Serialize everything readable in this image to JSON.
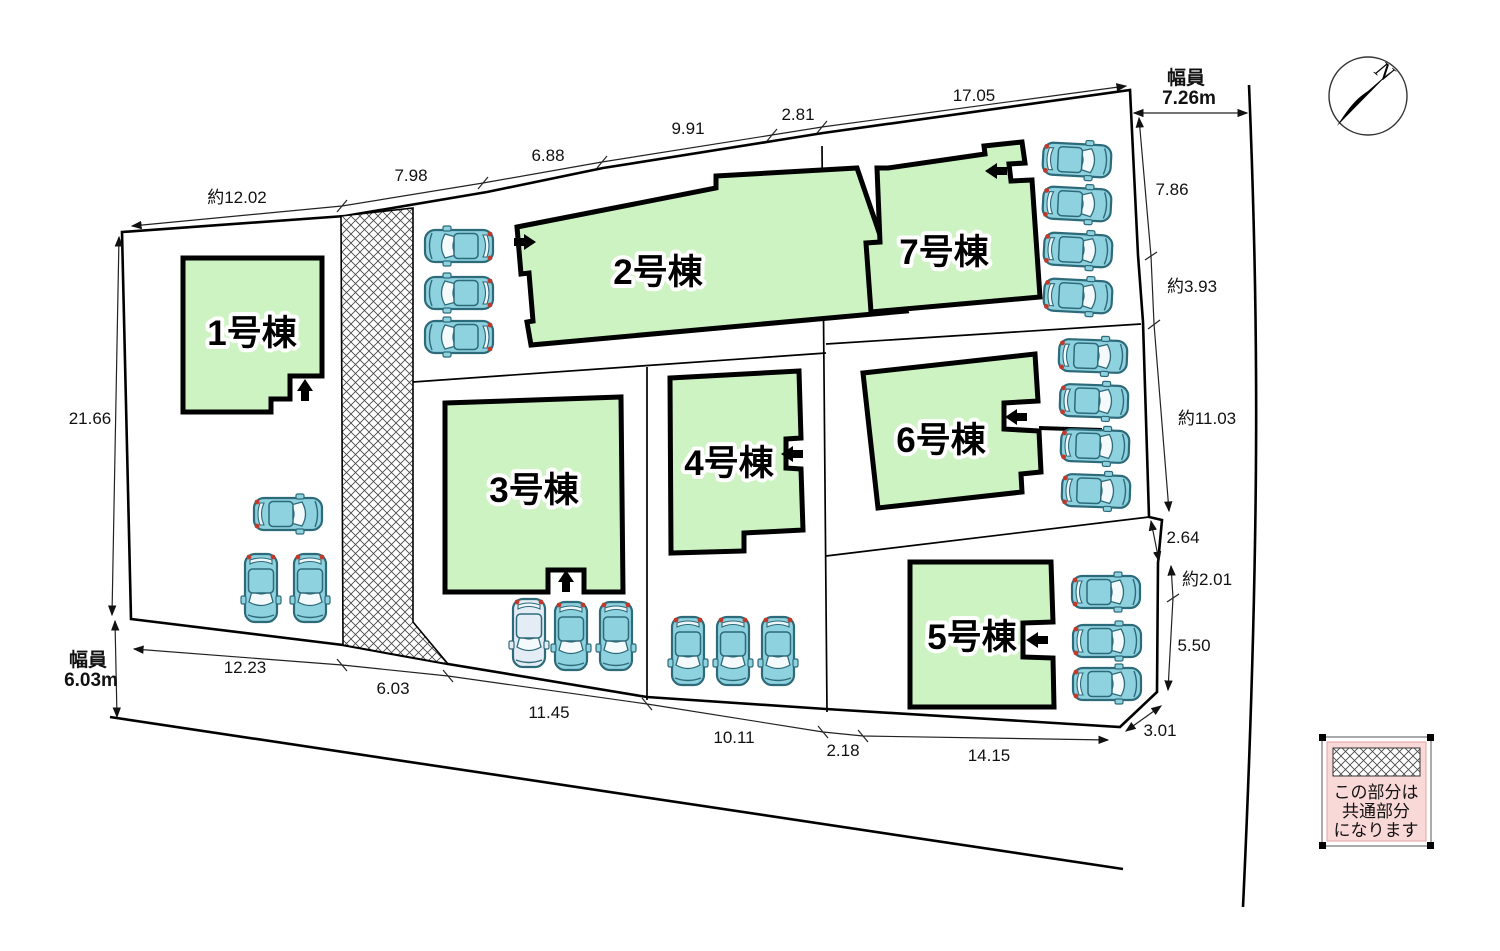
{
  "buildings": [
    {
      "label": "1号棟"
    },
    {
      "label": "2号棟"
    },
    {
      "label": "3号棟"
    },
    {
      "label": "4号棟"
    },
    {
      "label": "5号棟"
    },
    {
      "label": "6号棟"
    },
    {
      "label": "7号棟"
    }
  ],
  "dimensions": {
    "top": [
      "約12.02",
      "7.98",
      "6.88",
      "9.91",
      "2.81",
      "17.05"
    ],
    "left": [
      "21.66"
    ],
    "right": [
      "7.86",
      "約3.93",
      "約11.03",
      "2.64",
      "約2.01",
      "5.50",
      "3.01"
    ],
    "bottom": [
      "12.23",
      "6.03",
      "11.45",
      "10.11",
      "2.18",
      "14.15"
    ]
  },
  "roads": [
    {
      "label": "幅員",
      "value": "7.26m"
    },
    {
      "label": "幅員",
      "value": "6.03m"
    }
  ],
  "compass": {
    "label": "N"
  },
  "legend": {
    "line1": "この部分は",
    "line2": "共通部分",
    "line3": "になります"
  },
  "colors": {
    "building": "#cdf3c2",
    "car_body": "#8ed1df",
    "car_outline": "#2e6b7a",
    "car_white": "#e4edf6",
    "legend_bg": "#f9d8d8",
    "line": "#000000"
  }
}
